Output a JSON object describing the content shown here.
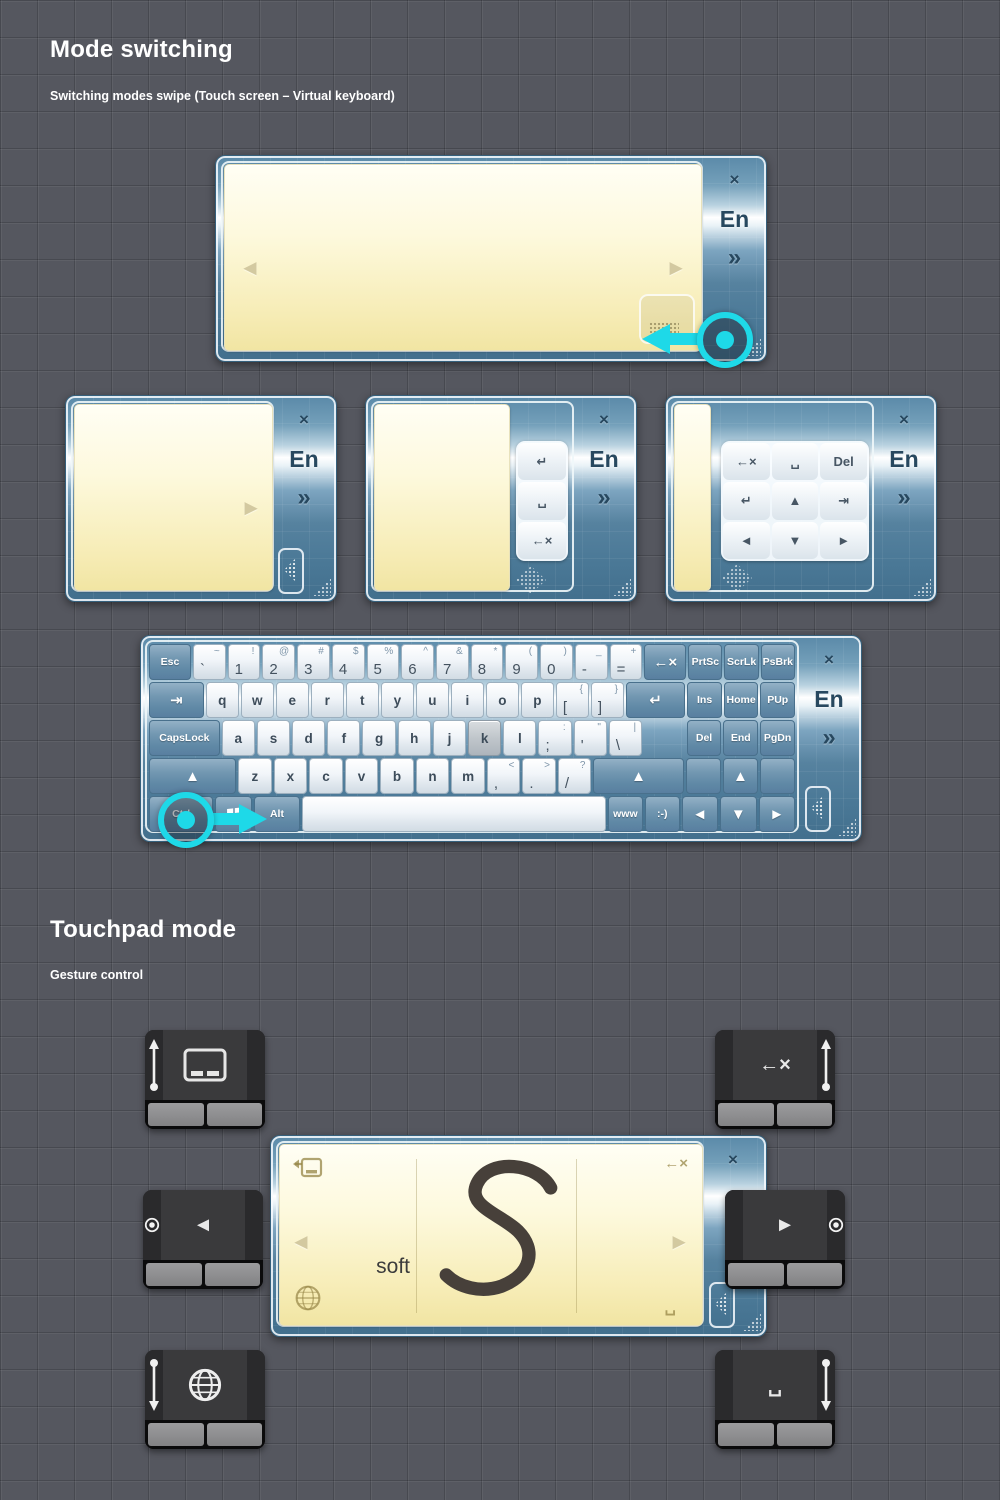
{
  "sections": {
    "mode_switching": {
      "title": "Mode switching",
      "subtitle": "Switching modes swipe (Touch screen – Virtual keyboard)"
    },
    "touchpad_mode": {
      "title": "Touchpad mode",
      "subtitle": "Gesture control"
    }
  },
  "colors": {
    "accent_cyan": "#1ed9e8",
    "panel_blue": "#5a89a8",
    "note_yellow": "#f7edb8",
    "pad_dark": "#3a3a3c"
  },
  "panels": {
    "sidebar": {
      "close": "×",
      "lang": "En",
      "more": "»"
    },
    "arrows": {
      "prev": "◄",
      "next": "►"
    },
    "mini_column": [
      {
        "n": "enter",
        "t": "↵"
      },
      {
        "n": "space",
        "t": "␣"
      },
      {
        "n": "backspace",
        "t": "←×"
      }
    ],
    "mini_grid": [
      [
        {
          "n": "backspace",
          "t": "←×"
        },
        {
          "n": "space",
          "t": "␣"
        },
        {
          "n": "delete",
          "t": "Del"
        }
      ],
      [
        {
          "n": "enter",
          "t": "↵"
        },
        {
          "n": "up",
          "t": "▲"
        },
        {
          "n": "tab",
          "t": "⇥"
        }
      ],
      [
        {
          "n": "left",
          "t": "◄"
        },
        {
          "n": "down",
          "t": "▼"
        },
        {
          "n": "right",
          "t": "►"
        }
      ]
    ]
  },
  "keyboard": {
    "rows": [
      [
        {
          "n": "esc",
          "t": "Esc",
          "k": "mod",
          "w": 1.3,
          "sm": 1
        },
        {
          "n": "backtick",
          "t": "`",
          "s": "~",
          "w": 1
        },
        {
          "n": "1",
          "t": "1",
          "s": "!"
        },
        {
          "n": "2",
          "t": "2",
          "s": "@"
        },
        {
          "n": "3",
          "t": "3",
          "s": "#"
        },
        {
          "n": "4",
          "t": "4",
          "s": "$"
        },
        {
          "n": "5",
          "t": "5",
          "s": "%"
        },
        {
          "n": "6",
          "t": "6",
          "s": "^"
        },
        {
          "n": "7",
          "t": "7",
          "s": "&"
        },
        {
          "n": "8",
          "t": "8",
          "s": "*"
        },
        {
          "n": "9",
          "t": "9",
          "s": "("
        },
        {
          "n": "0",
          "t": "0",
          "s": ")"
        },
        {
          "n": "minus",
          "t": "-",
          "s": "_"
        },
        {
          "n": "equals",
          "t": "=",
          "s": "+"
        },
        {
          "n": "backspace",
          "t": "←×",
          "k": "mod",
          "w": 1.3,
          "g": 1
        },
        {
          "n": "prtsc",
          "t": "PrtSc",
          "k": "mod",
          "w": 1.05,
          "sm": 1
        },
        {
          "n": "scrlk",
          "t": "ScrLk",
          "k": "mod",
          "w": 1.05,
          "sm": 1
        },
        {
          "n": "psbrk",
          "t": "PsBrk",
          "k": "mod",
          "w": 1.05,
          "sm": 1
        }
      ],
      [
        {
          "n": "tab",
          "t": "⇥",
          "k": "mod",
          "w": 1.7,
          "g": 1
        },
        {
          "n": "q",
          "t": "q"
        },
        {
          "n": "w",
          "t": "w"
        },
        {
          "n": "e",
          "t": "e"
        },
        {
          "n": "r",
          "t": "r"
        },
        {
          "n": "t",
          "t": "t"
        },
        {
          "n": "y",
          "t": "y"
        },
        {
          "n": "u",
          "t": "u"
        },
        {
          "n": "i",
          "t": "i"
        },
        {
          "n": "o",
          "t": "o"
        },
        {
          "n": "p",
          "t": "p"
        },
        {
          "n": "bracket-open",
          "t": "[",
          "s": "{"
        },
        {
          "n": "bracket-close",
          "t": "]",
          "s": "}"
        },
        {
          "n": "enter",
          "t": "↵",
          "k": "mod",
          "w": 1.85,
          "g": 1
        },
        {
          "n": "ins",
          "t": "Ins",
          "k": "mod",
          "w": 1.05,
          "sm": 1
        },
        {
          "n": "home",
          "t": "Home",
          "k": "mod",
          "w": 1.05,
          "sm": 1
        },
        {
          "n": "pup",
          "t": "PUp",
          "k": "mod",
          "w": 1.05,
          "sm": 1
        }
      ],
      [
        {
          "n": "capslock",
          "t": "CapsLock",
          "k": "mod",
          "w": 2.2,
          "sm": 1
        },
        {
          "n": "a",
          "t": "a"
        },
        {
          "n": "s",
          "t": "s"
        },
        {
          "n": "d",
          "t": "d"
        },
        {
          "n": "f",
          "t": "f"
        },
        {
          "n": "g",
          "t": "g"
        },
        {
          "n": "h",
          "t": "h"
        },
        {
          "n": "j",
          "t": "j"
        },
        {
          "n": "k",
          "t": "k",
          "hl": 1
        },
        {
          "n": "l",
          "t": "l"
        },
        {
          "n": "semicolon",
          "t": ";",
          "s": ":"
        },
        {
          "n": "quote",
          "t": "'",
          "s": "\""
        },
        {
          "n": "backslash",
          "t": "\\",
          "s": "|"
        },
        {
          "n": "spacer",
          "t": "",
          "k": "gap",
          "w": 1.3
        },
        {
          "n": "del",
          "t": "Del",
          "k": "mod",
          "w": 1.05,
          "sm": 1
        },
        {
          "n": "end",
          "t": "End",
          "k": "mod",
          "w": 1.05,
          "sm": 1
        },
        {
          "n": "pgdn",
          "t": "PgDn",
          "k": "mod",
          "w": 1.05,
          "sm": 1
        }
      ],
      [
        {
          "n": "shift-left",
          "t": "▲",
          "k": "mod",
          "w": 2.7,
          "g": 1
        },
        {
          "n": "z",
          "t": "z"
        },
        {
          "n": "x",
          "t": "x"
        },
        {
          "n": "c",
          "t": "c"
        },
        {
          "n": "v",
          "t": "v"
        },
        {
          "n": "b",
          "t": "b"
        },
        {
          "n": "n",
          "t": "n"
        },
        {
          "n": "m",
          "t": "m"
        },
        {
          "n": "comma",
          "t": ",",
          "s": "<"
        },
        {
          "n": "period",
          "t": ".",
          "s": ">"
        },
        {
          "n": "slash",
          "t": "/",
          "s": "?"
        },
        {
          "n": "shift-right",
          "t": "▲",
          "k": "mod",
          "w": 2.8,
          "g": 1
        },
        {
          "n": "blank-left",
          "t": "",
          "k": "mod",
          "w": 1.05
        },
        {
          "n": "arrow-up",
          "t": "▲",
          "k": "mod",
          "w": 1.05,
          "g": 1
        },
        {
          "n": "blank-right",
          "t": "",
          "k": "mod",
          "w": 1.05
        }
      ],
      [
        {
          "n": "ctrl",
          "t": "Ctrl",
          "k": "mod",
          "w": 1.9,
          "sm": 1
        },
        {
          "n": "win",
          "t": "",
          "k": "mod",
          "w": 1.05,
          "icon": "windows"
        },
        {
          "n": "alt",
          "t": "Alt",
          "k": "mod",
          "w": 1.35,
          "sm": 1
        },
        {
          "n": "spacebar",
          "t": "",
          "w": 9.2
        },
        {
          "n": "www",
          "t": "www",
          "k": "mod",
          "w": 1.0,
          "sm": 1
        },
        {
          "n": "smiley",
          "t": ":-)",
          "k": "mod",
          "w": 1.0,
          "sm": 1
        },
        {
          "n": "arrow-left",
          "t": "◄",
          "k": "mod",
          "w": 1.05,
          "g": 1
        },
        {
          "n": "arrow-down",
          "t": "▼",
          "k": "mod",
          "w": 1.05,
          "g": 1
        },
        {
          "n": "arrow-right",
          "t": "►",
          "k": "mod",
          "w": 1.05,
          "g": 1
        }
      ]
    ]
  },
  "handwriting": {
    "word": "soft",
    "backspace_hint": "←×",
    "space_hint": "␣"
  },
  "touchpads": [
    {
      "n": "touchpad-mode",
      "icon": "touchpad",
      "glyph": "",
      "gesture": "swipe-up",
      "edge": "left"
    },
    {
      "n": "backspace",
      "icon": "glyph",
      "glyph": "←×",
      "gesture": "swipe-up",
      "edge": "right"
    },
    {
      "n": "previous",
      "icon": "glyph",
      "glyph": "◄",
      "gesture": "tap",
      "edge": "left"
    },
    {
      "n": "next",
      "icon": "glyph",
      "glyph": "►",
      "gesture": "tap",
      "edge": "right"
    },
    {
      "n": "language",
      "icon": "globe",
      "glyph": "",
      "gesture": "swipe-down",
      "edge": "left"
    },
    {
      "n": "space",
      "icon": "glyph",
      "glyph": "␣",
      "gesture": "swipe-down",
      "edge": "right"
    }
  ]
}
